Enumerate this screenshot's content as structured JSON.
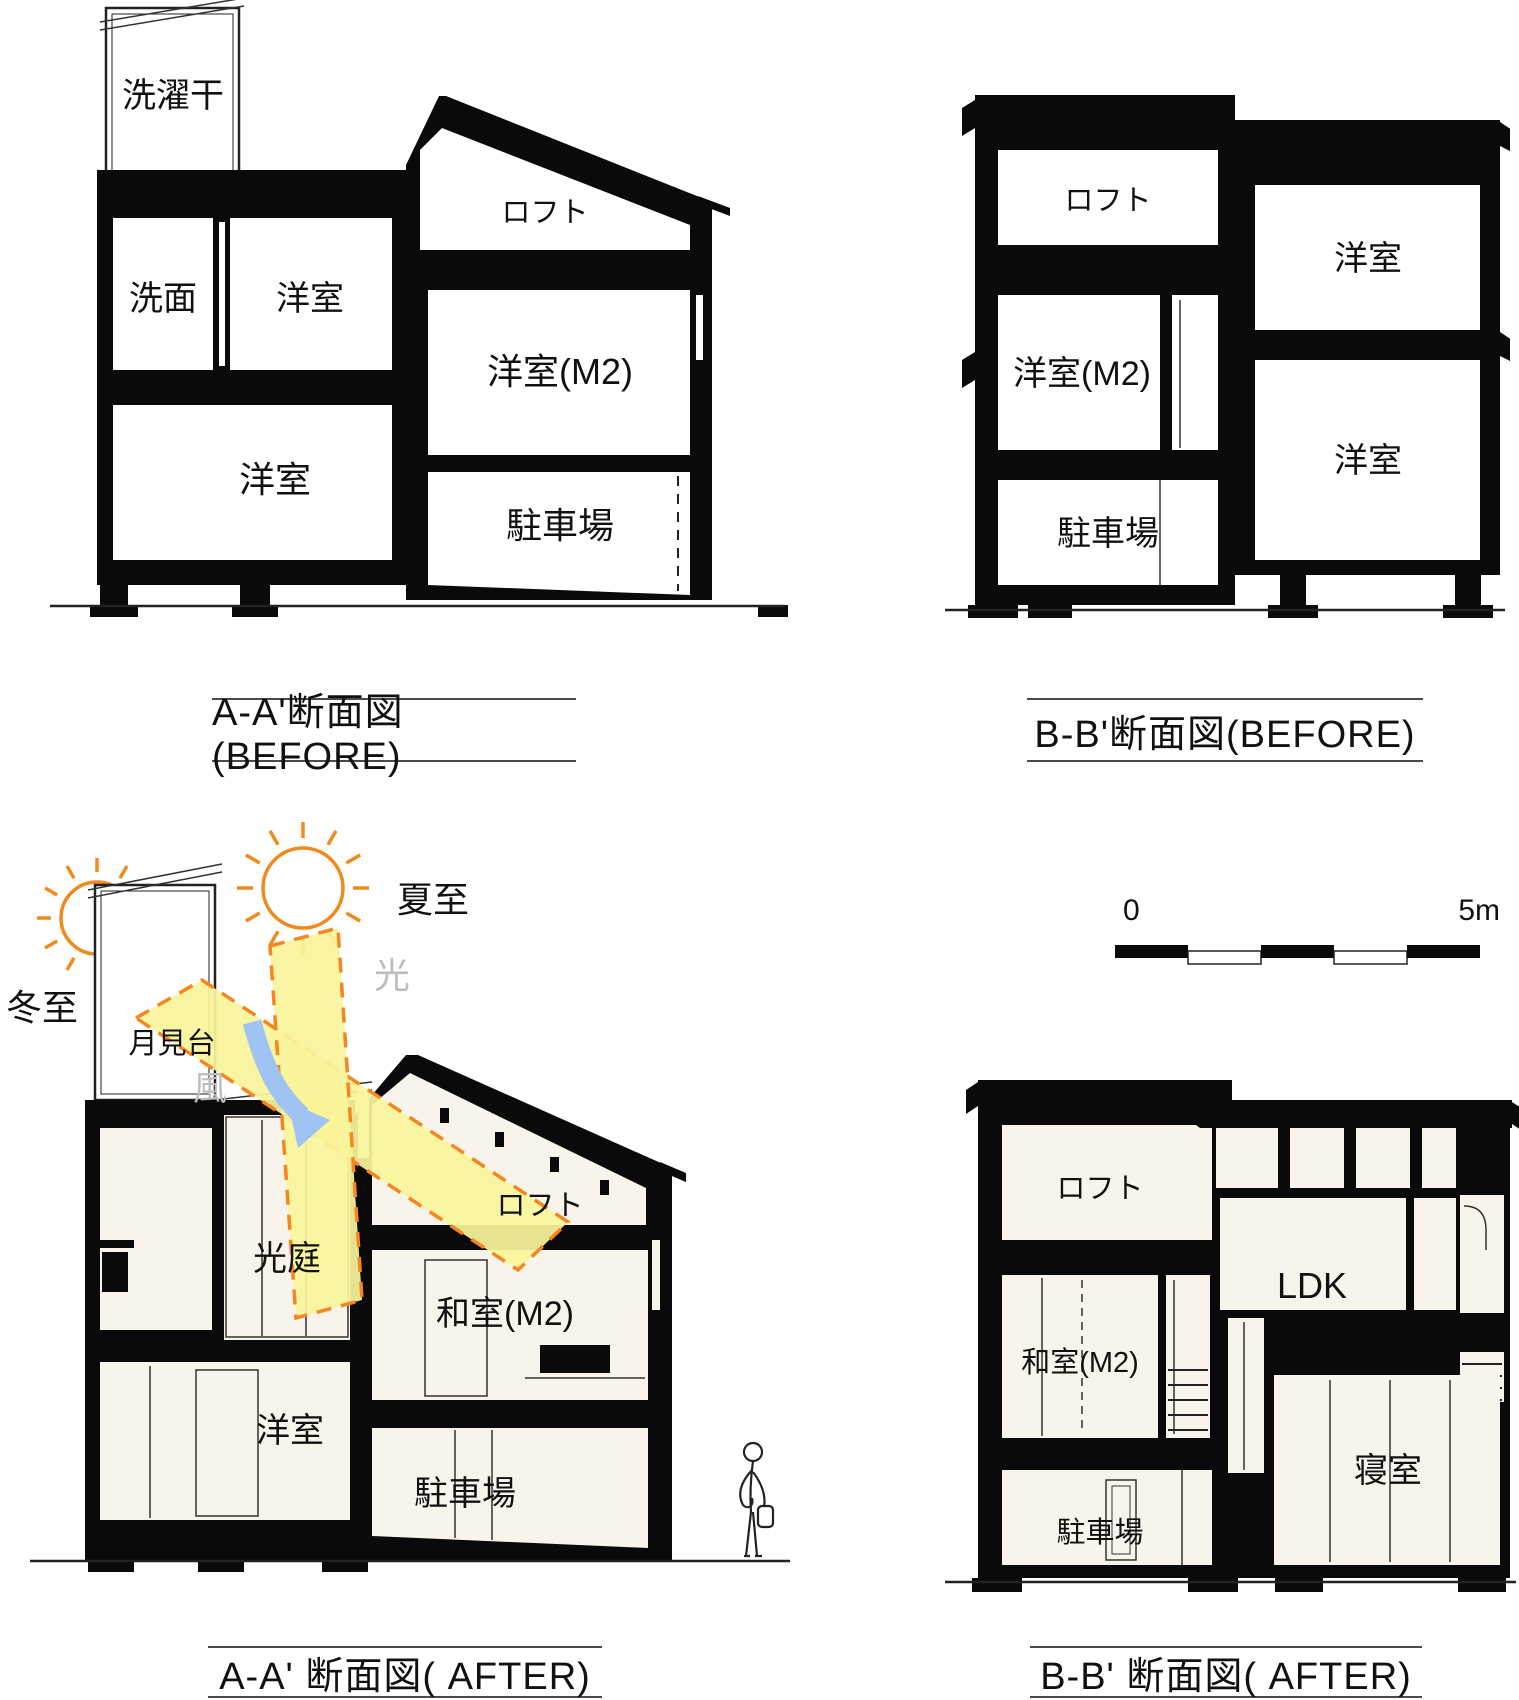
{
  "colors": {
    "wall_black": "#0a0a0a",
    "room_fill_before": "#ffffff",
    "room_fill_after": "#f8f4eb",
    "light_beam_yellow": "#faf49b",
    "beam_dash_orange": "#f6861f",
    "sun_orange": "#f08a1d",
    "wind_arrow_blue": "#9fc3f2",
    "muted_gray_text": "#bdbdbd",
    "caption_rule_gray": "#4a4a4a"
  },
  "panels": {
    "aa_before": {
      "caption": "A-A'断面図(BEFORE)",
      "rooms": {
        "laundry_deck": "洗濯干",
        "washroom": "洗面",
        "western_room_2f": "洋室",
        "loft": "ロフト",
        "western_room_m2": "洋室(M2)",
        "western_room_1f": "洋室",
        "parking": "駐車場"
      }
    },
    "bb_before": {
      "caption": "B-B'断面図(BEFORE)",
      "rooms": {
        "loft": "ロフト",
        "western_room_2f": "洋室",
        "western_room_m2": "洋室(M2)",
        "parking": "駐車場",
        "western_room_1f": "洋室"
      }
    },
    "aa_after": {
      "caption": "A-A' 断面図( AFTER)",
      "annotations": {
        "summer_solstice": "夏至",
        "winter_solstice": "冬至",
        "light": "光",
        "wind": "風",
        "moon_viewing_deck": "月見台",
        "light_court": "光庭"
      },
      "rooms": {
        "loft": "ロフト",
        "japanese_room_m2": "和室(M2)",
        "western_room_1f": "洋室",
        "parking": "駐車場"
      }
    },
    "bb_after": {
      "caption": "B-B' 断面図( AFTER)",
      "scale_bar": {
        "start_label": "0",
        "end_label": "5m"
      },
      "rooms": {
        "loft": "ロフト",
        "ldk": "LDK",
        "japanese_room_m2": "和室(M2)",
        "bedroom": "寝室",
        "parking": "駐車場"
      }
    }
  }
}
